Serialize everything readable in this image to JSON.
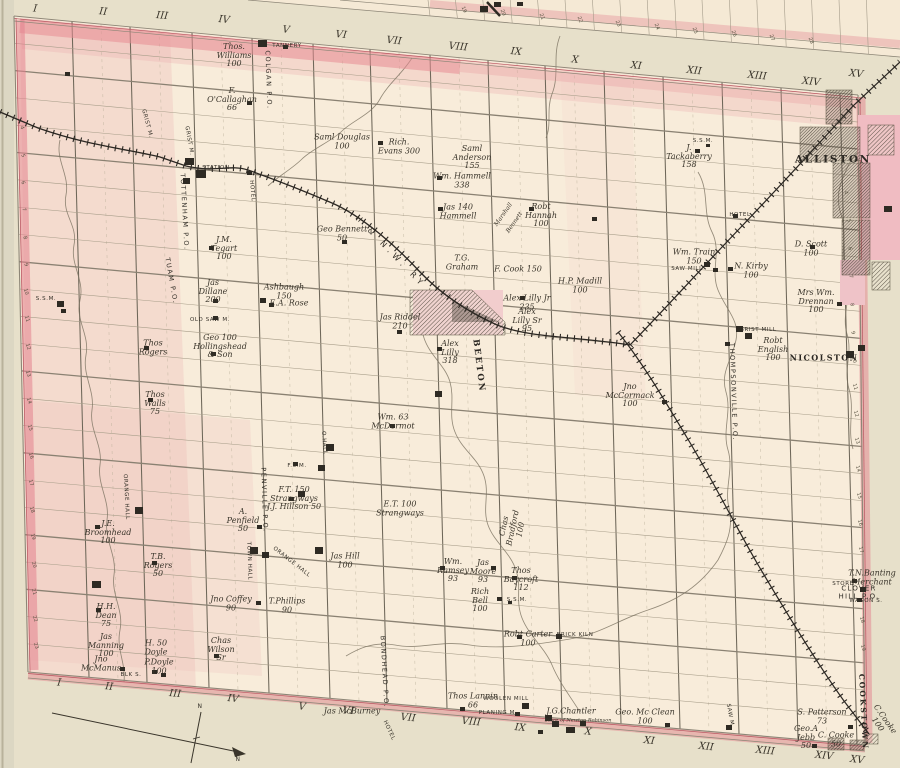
{
  "sheet": {
    "width": 900,
    "height": 768
  },
  "colors": {
    "paper": "#f8ecda",
    "margin": "#e7e0ca",
    "page_edge": "#dcd7c3",
    "pink_boundary": "#e28d9a",
    "pink_wash": "#eebcbc",
    "ink": "#3a352b",
    "grid": "#a79d89",
    "railway": "#2b2722",
    "river": "#7b7260"
  },
  "labels": [
    {
      "t": "I",
      "x": 35,
      "y": 10,
      "r": 6,
      "c": "num"
    },
    {
      "t": "II",
      "x": 103,
      "y": 13,
      "r": 6,
      "c": "num"
    },
    {
      "t": "III",
      "x": 162,
      "y": 17,
      "r": 6,
      "c": "num"
    },
    {
      "t": "IV",
      "x": 224,
      "y": 21,
      "r": 6,
      "c": "num"
    },
    {
      "t": "V",
      "x": 286,
      "y": 31,
      "r": 6,
      "c": "num"
    },
    {
      "t": "VI",
      "x": 341,
      "y": 36,
      "r": 6,
      "c": "num"
    },
    {
      "t": "VII",
      "x": 394,
      "y": 42,
      "r": 6,
      "c": "num"
    },
    {
      "t": "VIII",
      "x": 458,
      "y": 48,
      "r": 6,
      "c": "num"
    },
    {
      "t": "IX",
      "x": 516,
      "y": 53,
      "r": 6,
      "c": "num"
    },
    {
      "t": "X",
      "x": 575,
      "y": 61,
      "r": 6,
      "c": "num"
    },
    {
      "t": "XI",
      "x": 636,
      "y": 67,
      "r": 6,
      "c": "num"
    },
    {
      "t": "XII",
      "x": 694,
      "y": 72,
      "r": 6,
      "c": "num"
    },
    {
      "t": "XIII",
      "x": 757,
      "y": 77,
      "r": 6,
      "c": "num"
    },
    {
      "t": "XIV",
      "x": 811,
      "y": 83,
      "r": 6,
      "c": "num"
    },
    {
      "t": "XV",
      "x": 856,
      "y": 75,
      "r": 6,
      "c": "num"
    },
    {
      "t": "I",
      "x": 59,
      "y": 684,
      "r": 6,
      "c": "num"
    },
    {
      "t": "II",
      "x": 109,
      "y": 688,
      "r": 6,
      "c": "num"
    },
    {
      "t": "III",
      "x": 175,
      "y": 695,
      "r": 6,
      "c": "num"
    },
    {
      "t": "IV",
      "x": 233,
      "y": 700,
      "r": 6,
      "c": "num"
    },
    {
      "t": "V",
      "x": 302,
      "y": 708,
      "r": 6,
      "c": "num"
    },
    {
      "t": "VI",
      "x": 348,
      "y": 712,
      "r": 6,
      "c": "num"
    },
    {
      "t": "VII",
      "x": 408,
      "y": 719,
      "r": 6,
      "c": "num"
    },
    {
      "t": "VIII",
      "x": 471,
      "y": 723,
      "r": 6,
      "c": "num"
    },
    {
      "t": "IX",
      "x": 520,
      "y": 729,
      "r": 6,
      "c": "num"
    },
    {
      "t": "X",
      "x": 588,
      "y": 733,
      "r": 6,
      "c": "num"
    },
    {
      "t": "XI",
      "x": 649,
      "y": 742,
      "r": 6,
      "c": "num"
    },
    {
      "t": "XII",
      "x": 706,
      "y": 748,
      "r": 6,
      "c": "num"
    },
    {
      "t": "XIII",
      "x": 765,
      "y": 752,
      "r": 6,
      "c": "num"
    },
    {
      "t": "XIV",
      "x": 824,
      "y": 757,
      "r": 6,
      "c": "num"
    },
    {
      "t": "XV",
      "x": 857,
      "y": 761,
      "r": 6,
      "c": "num"
    },
    {
      "t": "TANNERY",
      "x": 287,
      "y": 47,
      "c": "f"
    },
    {
      "t": "Thos.\nWilliams\n100",
      "x": 234,
      "y": 56
    },
    {
      "t": "COLGAN P.O.",
      "x": 268,
      "y": 80,
      "r": 88,
      "c": "p"
    },
    {
      "t": "F.\nO'Callaghan\n66",
      "x": 232,
      "y": 100
    },
    {
      "t": "GRIST M.",
      "x": 146,
      "y": 124,
      "r": 75,
      "c": "f"
    },
    {
      "t": "GRIST M.",
      "x": 188,
      "y": 141,
      "r": 80,
      "c": "f"
    },
    {
      "t": "Saml Douglas\n100",
      "x": 342,
      "y": 142
    },
    {
      "t": "Rich.\nEvans 300",
      "x": 399,
      "y": 147
    },
    {
      "t": "Saml\nAnderson\n155",
      "x": 472,
      "y": 158
    },
    {
      "t": "Wm. Hammell\n338",
      "x": 462,
      "y": 181
    },
    {
      "t": "Jas 140\nHammell",
      "x": 458,
      "y": 212
    },
    {
      "t": "Marshall",
      "x": 504,
      "y": 215,
      "r": -55,
      "s": 6
    },
    {
      "t": "Bennett",
      "x": 515,
      "y": 223,
      "r": -55,
      "s": 6
    },
    {
      "t": "Robt\nHannah\n100",
      "x": 541,
      "y": 216
    },
    {
      "t": "S.S.M.",
      "x": 703,
      "y": 142,
      "c": "f"
    },
    {
      "t": "J.\nTackaberry\n158",
      "x": 689,
      "y": 157
    },
    {
      "t": "STATION",
      "x": 216,
      "y": 169,
      "c": "f"
    },
    {
      "t": "HOTEL",
      "x": 251,
      "y": 191,
      "r": 85,
      "c": "f"
    },
    {
      "t": "TOTTENHAM P.O.",
      "x": 184,
      "y": 212,
      "r": 87,
      "c": "p"
    },
    {
      "t": "TUAM P.O.",
      "x": 171,
      "y": 281,
      "r": 80,
      "c": "p"
    },
    {
      "t": "J.M.\nTegart\n100",
      "x": 224,
      "y": 249
    },
    {
      "t": "Geo Bennett\n50",
      "x": 342,
      "y": 234
    },
    {
      "t": "H & N.W. RY",
      "x": 390,
      "y": 252,
      "r": 46,
      "c": "rw"
    },
    {
      "t": "T.G.\nGraham",
      "x": 462,
      "y": 263
    },
    {
      "t": "F. Cook 150",
      "x": 518,
      "y": 270
    },
    {
      "t": "H.P. Madill\n100",
      "x": 580,
      "y": 286
    },
    {
      "t": "Alex Lilly Jr\n235",
      "x": 527,
      "y": 303
    },
    {
      "t": "Alex\nLilly Sr\n95",
      "x": 527,
      "y": 321
    },
    {
      "t": "Jas Riddel\n210",
      "x": 400,
      "y": 322
    },
    {
      "t": "Alex\nLilly\n318",
      "x": 450,
      "y": 353
    },
    {
      "t": "BEETON",
      "x": 478,
      "y": 366,
      "r": 83,
      "c": "tv"
    },
    {
      "t": "S.S.M.",
      "x": 46,
      "y": 300,
      "c": "f"
    },
    {
      "t": "Jas\nDillane\n200",
      "x": 213,
      "y": 292
    },
    {
      "t": "Ashbaugh\n150",
      "x": 284,
      "y": 292
    },
    {
      "t": "E.A. Rose",
      "x": 289,
      "y": 304
    },
    {
      "t": "OLD SAW M.",
      "x": 210,
      "y": 321,
      "c": "f"
    },
    {
      "t": "Geo 100\nHollingshead\n& Son",
      "x": 220,
      "y": 347
    },
    {
      "t": "Thos\nRogers",
      "x": 153,
      "y": 348
    },
    {
      "t": "Thos\nWalls\n75",
      "x": 155,
      "y": 404
    },
    {
      "t": "Wm. Train\n150",
      "x": 694,
      "y": 257
    },
    {
      "t": "SAW MILL",
      "x": 687,
      "y": 270,
      "c": "f"
    },
    {
      "t": "HOTEL",
      "x": 740,
      "y": 216,
      "c": "f"
    },
    {
      "t": "N. Kirby\n100",
      "x": 751,
      "y": 271
    },
    {
      "t": "D. Scott\n100",
      "x": 811,
      "y": 249
    },
    {
      "t": "Mrs Wm.\nDrennan\n100",
      "x": 816,
      "y": 302
    },
    {
      "t": "GRIST MILL",
      "x": 758,
      "y": 331,
      "c": "f"
    },
    {
      "t": "THOMPSONVILLE P.O.",
      "x": 733,
      "y": 392,
      "r": 88,
      "c": "p"
    },
    {
      "t": "Robt\nEnglish\n100",
      "x": 773,
      "y": 350
    },
    {
      "t": "NICOLSTON",
      "x": 824,
      "y": 358,
      "c": "t2"
    },
    {
      "t": "ALLISTON",
      "x": 833,
      "y": 160,
      "c": "t"
    },
    {
      "t": "Jno\nMcCormack\n100",
      "x": 630,
      "y": 396
    },
    {
      "t": "Wm. 63\nMcDermot",
      "x": 393,
      "y": 422
    },
    {
      "t": "F.S.M.",
      "x": 297,
      "y": 467,
      "c": "f"
    },
    {
      "t": "O.HALL",
      "x": 323,
      "y": 443,
      "r": 85,
      "c": "f"
    },
    {
      "t": "F.T. 150\nStrangways\nJ.J. Hillson 50",
      "x": 294,
      "y": 499
    },
    {
      "t": "PENVILLE P.O.",
      "x": 264,
      "y": 500,
      "r": 88,
      "c": "p"
    },
    {
      "t": "E.T. 100\nStrangways",
      "x": 400,
      "y": 509
    },
    {
      "t": "Chas\nBradford\n100",
      "x": 513,
      "y": 528,
      "r": -78
    },
    {
      "t": "A.\nPenfield\n50",
      "x": 243,
      "y": 521
    },
    {
      "t": "TOWN HALL",
      "x": 248,
      "y": 561,
      "r": 88,
      "c": "f"
    },
    {
      "t": "ORANGE HALL",
      "x": 291,
      "y": 563,
      "r": 38,
      "c": "f"
    },
    {
      "t": "Jas Hill\n100",
      "x": 345,
      "y": 561
    },
    {
      "t": "ORANGE HALL",
      "x": 125,
      "y": 497,
      "r": 87,
      "c": "f"
    },
    {
      "t": "J.E.\nBroomhead\n100",
      "x": 108,
      "y": 533
    },
    {
      "t": "T.B.\nRogers\n50",
      "x": 158,
      "y": 566
    },
    {
      "t": "Wm.\nRamsey\n93",
      "x": 453,
      "y": 571
    },
    {
      "t": "Jas\nMoore\n93",
      "x": 483,
      "y": 572
    },
    {
      "t": "Thos\nBaycroft\n112",
      "x": 521,
      "y": 580
    },
    {
      "t": "Rich\nBell\n100",
      "x": 480,
      "y": 601
    },
    {
      "t": "S.S.M.",
      "x": 517,
      "y": 601,
      "c": "f"
    },
    {
      "t": "H.H.\nDean\n75",
      "x": 106,
      "y": 616
    },
    {
      "t": "Jas\nManning\n100",
      "x": 106,
      "y": 646
    },
    {
      "t": "Jno\nMcManus",
      "x": 101,
      "y": 664
    },
    {
      "t": "H. 50\nDoyle",
      "x": 156,
      "y": 648
    },
    {
      "t": "P.Doyle\n100",
      "x": 159,
      "y": 667
    },
    {
      "t": "BLK S.",
      "x": 131,
      "y": 676,
      "c": "f"
    },
    {
      "t": "Chas\nWilson\nSr",
      "x": 221,
      "y": 650
    },
    {
      "t": "Jno Coffey\n90",
      "x": 231,
      "y": 604
    },
    {
      "t": "T.Phillips\n90",
      "x": 287,
      "y": 606
    },
    {
      "t": "Robt Carter\n100",
      "x": 528,
      "y": 639
    },
    {
      "t": "BRICK KILN",
      "x": 575,
      "y": 636,
      "c": "f"
    },
    {
      "t": "BONDHEAD P.O.",
      "x": 384,
      "y": 672,
      "r": 87,
      "c": "p"
    },
    {
      "t": "Thos Lannin\n66",
      "x": 473,
      "y": 701
    },
    {
      "t": "WOOLEN MILL",
      "x": 506,
      "y": 700,
      "c": "f"
    },
    {
      "t": "PLANING M.",
      "x": 498,
      "y": 714,
      "c": "f"
    },
    {
      "t": "J.G.Chantler",
      "x": 571,
      "y": 712
    },
    {
      "t": "Store of Newton Robinson",
      "x": 578,
      "y": 721,
      "c": "f2"
    },
    {
      "t": "Jas McBurney",
      "x": 352,
      "y": 712
    },
    {
      "t": "HOTEL",
      "x": 388,
      "y": 731,
      "r": 65,
      "c": "f"
    },
    {
      "t": "Geo. Mc Clean\n100",
      "x": 645,
      "y": 717
    },
    {
      "t": "S. Patterson\n73",
      "x": 822,
      "y": 717
    },
    {
      "t": "Geo.A\nJebb\n50",
      "x": 806,
      "y": 738
    },
    {
      "t": "C. Cooke\n50",
      "x": 836,
      "y": 740
    },
    {
      "t": "C.Cooke\n100",
      "x": 881,
      "y": 722,
      "r": 55
    },
    {
      "t": "SAW M.",
      "x": 729,
      "y": 716,
      "r": 80,
      "c": "f"
    },
    {
      "t": "T.N.Banting\nMerchant",
      "x": 872,
      "y": 578
    },
    {
      "t": "STORE",
      "x": 843,
      "y": 585,
      "c": "f"
    },
    {
      "t": "CLOVER HILL P.O.",
      "x": 859,
      "y": 593,
      "c": "p2"
    },
    {
      "t": "WAGON S.",
      "x": 866,
      "y": 602,
      "c": "f"
    },
    {
      "t": "COOKSTOWN",
      "x": 863,
      "y": 712,
      "r": 87,
      "c": "tv",
      "s": 7.5
    },
    {
      "t": "N",
      "x": 200,
      "y": 707,
      "c": "f",
      "s": 6
    },
    {
      "t": "N",
      "x": 238,
      "y": 760,
      "c": "f",
      "s": 6
    },
    {
      "t": "4",
      "x": 845,
      "y": 193,
      "r": 75,
      "c": "lot"
    },
    {
      "t": "5",
      "x": 848,
      "y": 221,
      "r": 75,
      "c": "lot"
    },
    {
      "t": "6",
      "x": 849,
      "y": 249,
      "r": 75,
      "c": "lot"
    },
    {
      "t": "7",
      "x": 850,
      "y": 277,
      "r": 75,
      "c": "lot"
    },
    {
      "t": "8",
      "x": 851,
      "y": 305,
      "r": 75,
      "c": "lot"
    },
    {
      "t": "9",
      "x": 852,
      "y": 333,
      "r": 75,
      "c": "lot"
    },
    {
      "t": "10",
      "x": 853,
      "y": 360,
      "r": 75,
      "c": "lot"
    },
    {
      "t": "11",
      "x": 854,
      "y": 387,
      "r": 75,
      "c": "lot"
    },
    {
      "t": "12",
      "x": 855,
      "y": 414,
      "r": 75,
      "c": "lot"
    },
    {
      "t": "13",
      "x": 856,
      "y": 441,
      "r": 75,
      "c": "lot"
    },
    {
      "t": "14",
      "x": 857,
      "y": 469,
      "r": 75,
      "c": "lot"
    },
    {
      "t": "15",
      "x": 858,
      "y": 496,
      "r": 75,
      "c": "lot"
    },
    {
      "t": "16",
      "x": 859,
      "y": 523,
      "r": 75,
      "c": "lot"
    },
    {
      "t": "17",
      "x": 860,
      "y": 550,
      "r": 75,
      "c": "lot"
    },
    {
      "t": "18",
      "x": 861,
      "y": 620,
      "r": 75,
      "c": "lot"
    },
    {
      "t": "19",
      "x": 862,
      "y": 648,
      "r": 75,
      "c": "lot"
    },
    {
      "t": "4",
      "x": 21,
      "y": 128,
      "r": 72,
      "c": "lot"
    },
    {
      "t": "5",
      "x": 22,
      "y": 156,
      "r": 72,
      "c": "lot"
    },
    {
      "t": "6",
      "x": 22,
      "y": 183,
      "r": 72,
      "c": "lot"
    },
    {
      "t": "7",
      "x": 23,
      "y": 210,
      "r": 72,
      "c": "lot"
    },
    {
      "t": "8",
      "x": 24,
      "y": 238,
      "r": 72,
      "c": "lot"
    },
    {
      "t": "9",
      "x": 25,
      "y": 265,
      "r": 72,
      "c": "lot"
    },
    {
      "t": "10",
      "x": 25,
      "y": 292,
      "r": 72,
      "c": "lot"
    },
    {
      "t": "11",
      "x": 26,
      "y": 319,
      "r": 72,
      "c": "lot"
    },
    {
      "t": "12",
      "x": 27,
      "y": 347,
      "r": 72,
      "c": "lot"
    },
    {
      "t": "13",
      "x": 27,
      "y": 374,
      "r": 72,
      "c": "lot"
    },
    {
      "t": "14",
      "x": 28,
      "y": 401,
      "r": 72,
      "c": "lot"
    },
    {
      "t": "15",
      "x": 29,
      "y": 428,
      "r": 72,
      "c": "lot"
    },
    {
      "t": "16",
      "x": 30,
      "y": 456,
      "r": 72,
      "c": "lot"
    },
    {
      "t": "17",
      "x": 30,
      "y": 483,
      "r": 72,
      "c": "lot"
    },
    {
      "t": "18",
      "x": 31,
      "y": 510,
      "r": 72,
      "c": "lot"
    },
    {
      "t": "19",
      "x": 32,
      "y": 537,
      "r": 72,
      "c": "lot"
    },
    {
      "t": "20",
      "x": 33,
      "y": 565,
      "r": 72,
      "c": "lot"
    },
    {
      "t": "21",
      "x": 33,
      "y": 592,
      "r": 72,
      "c": "lot"
    },
    {
      "t": "22",
      "x": 34,
      "y": 619,
      "r": 72,
      "c": "lot"
    },
    {
      "t": "23",
      "x": 35,
      "y": 646,
      "r": 72,
      "c": "lot"
    },
    {
      "t": "19",
      "x": 463,
      "y": 10,
      "r": 68,
      "c": "lot"
    },
    {
      "t": "20",
      "x": 502,
      "y": 13,
      "r": 68,
      "c": "lot"
    },
    {
      "t": "21",
      "x": 541,
      "y": 17,
      "r": 68,
      "c": "lot"
    },
    {
      "t": "22",
      "x": 579,
      "y": 20,
      "r": 68,
      "c": "lot"
    },
    {
      "t": "23",
      "x": 617,
      "y": 24,
      "r": 68,
      "c": "lot"
    },
    {
      "t": "24",
      "x": 656,
      "y": 27,
      "r": 68,
      "c": "lot"
    },
    {
      "t": "25",
      "x": 694,
      "y": 31,
      "r": 68,
      "c": "lot"
    },
    {
      "t": "26",
      "x": 733,
      "y": 34,
      "r": 68,
      "c": "lot"
    },
    {
      "t": "27",
      "x": 771,
      "y": 38,
      "r": 68,
      "c": "lot"
    },
    {
      "t": "28",
      "x": 810,
      "y": 41,
      "r": 68,
      "c": "lot"
    }
  ],
  "markers": [
    [
      65,
      72
    ],
    [
      258,
      40,
      9,
      7
    ],
    [
      283,
      45
    ],
    [
      247,
      101
    ],
    [
      185,
      158,
      9,
      7
    ],
    [
      196,
      170,
      10,
      8
    ],
    [
      183,
      178,
      7,
      6
    ],
    [
      247,
      171
    ],
    [
      209,
      246
    ],
    [
      213,
      299
    ],
    [
      260,
      298,
      6,
      5
    ],
    [
      269,
      303
    ],
    [
      213,
      316
    ],
    [
      211,
      352
    ],
    [
      144,
      346
    ],
    [
      57,
      301,
      7,
      6
    ],
    [
      61,
      309
    ],
    [
      695,
      149
    ],
    [
      706,
      144,
      4,
      3
    ],
    [
      378,
      141
    ],
    [
      437,
      176
    ],
    [
      438,
      207
    ],
    [
      529,
      207
    ],
    [
      592,
      217
    ],
    [
      342,
      240
    ],
    [
      520,
      296
    ],
    [
      397,
      330
    ],
    [
      437,
      347
    ],
    [
      390,
      424
    ],
    [
      435,
      391,
      7,
      6
    ],
    [
      293,
      462
    ],
    [
      326,
      444,
      8,
      7
    ],
    [
      318,
      465,
      7,
      6
    ],
    [
      298,
      491,
      7,
      6
    ],
    [
      289,
      497
    ],
    [
      257,
      525
    ],
    [
      250,
      547,
      8,
      7
    ],
    [
      262,
      552,
      7,
      6
    ],
    [
      315,
      547,
      8,
      7
    ],
    [
      135,
      507,
      8,
      7
    ],
    [
      92,
      581,
      9,
      7
    ],
    [
      95,
      525
    ],
    [
      152,
      561
    ],
    [
      96,
      608
    ],
    [
      120,
      667
    ],
    [
      152,
      670
    ],
    [
      161,
      673
    ],
    [
      214,
      654
    ],
    [
      256,
      601
    ],
    [
      148,
      398
    ],
    [
      440,
      566
    ],
    [
      491,
      566
    ],
    [
      512,
      576
    ],
    [
      497,
      597
    ],
    [
      508,
      601,
      4,
      3
    ],
    [
      517,
      635
    ],
    [
      556,
      634,
      6,
      5
    ],
    [
      460,
      707
    ],
    [
      522,
      703,
      7,
      6
    ],
    [
      515,
      712
    ],
    [
      545,
      715,
      7,
      6
    ],
    [
      552,
      721,
      7,
      6
    ],
    [
      566,
      727,
      9,
      6
    ],
    [
      580,
      721,
      6,
      5
    ],
    [
      538,
      730
    ],
    [
      665,
      723
    ],
    [
      848,
      725
    ],
    [
      812,
      744
    ],
    [
      726,
      725,
      6,
      5
    ],
    [
      852,
      579
    ],
    [
      857,
      598
    ],
    [
      860,
      587,
      6,
      5
    ],
    [
      728,
      267
    ],
    [
      704,
      262,
      6,
      5
    ],
    [
      713,
      268
    ],
    [
      733,
      214
    ],
    [
      810,
      245
    ],
    [
      837,
      302
    ],
    [
      736,
      326,
      7,
      6
    ],
    [
      745,
      333,
      7,
      6
    ],
    [
      725,
      342
    ],
    [
      662,
      400
    ],
    [
      846,
      351,
      8,
      7
    ],
    [
      858,
      345,
      7,
      6
    ],
    [
      480,
      6,
      8,
      6
    ],
    [
      494,
      2,
      7,
      5
    ],
    [
      517,
      2,
      6,
      4
    ],
    [
      884,
      206,
      8,
      6
    ]
  ]
}
